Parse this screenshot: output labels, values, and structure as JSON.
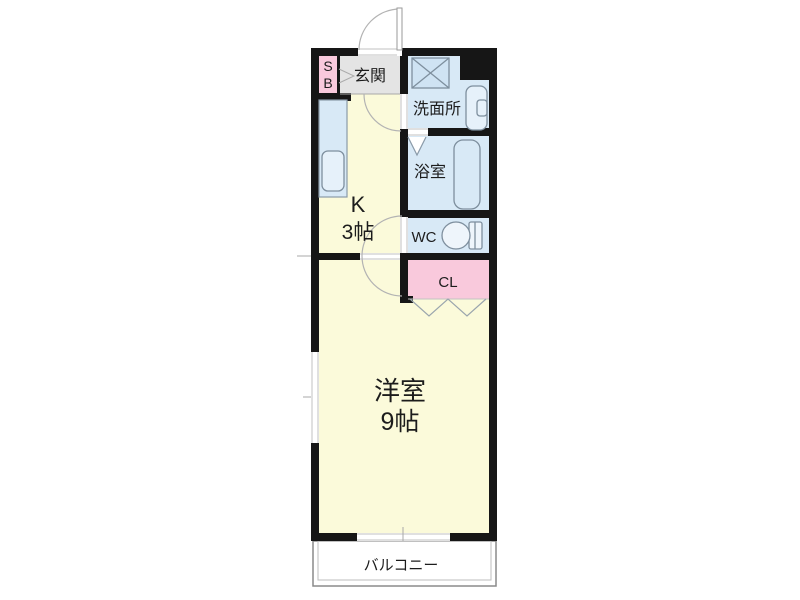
{
  "floorplan": {
    "rooms": {
      "shoe_box": {
        "line1": "S",
        "line2": "B"
      },
      "entrance": {
        "label": "玄関"
      },
      "washroom": {
        "label": "洗面所"
      },
      "bathroom": {
        "label": "浴室"
      },
      "toilet": {
        "label": "WC"
      },
      "closet": {
        "label": "CL"
      },
      "kitchen": {
        "name": "K",
        "size": "3帖"
      },
      "main_room": {
        "name": "洋室",
        "size": "9帖"
      },
      "balcony": {
        "label": "バルコニー"
      }
    },
    "colors": {
      "wall": "#161616",
      "tatami_yellow": "#fbfada",
      "wet_area_blue": "#d8e9f6",
      "closet_pink": "#f9c9dc",
      "entrance_gray": "#e4e4e4",
      "fixture_fill": "#cfe3f3",
      "fixture_light": "#e6f1fa",
      "fixture_outline": "#7e8f9e",
      "door_swing_line": "#b3b3b3",
      "label_text": "#1c1c1c"
    }
  }
}
